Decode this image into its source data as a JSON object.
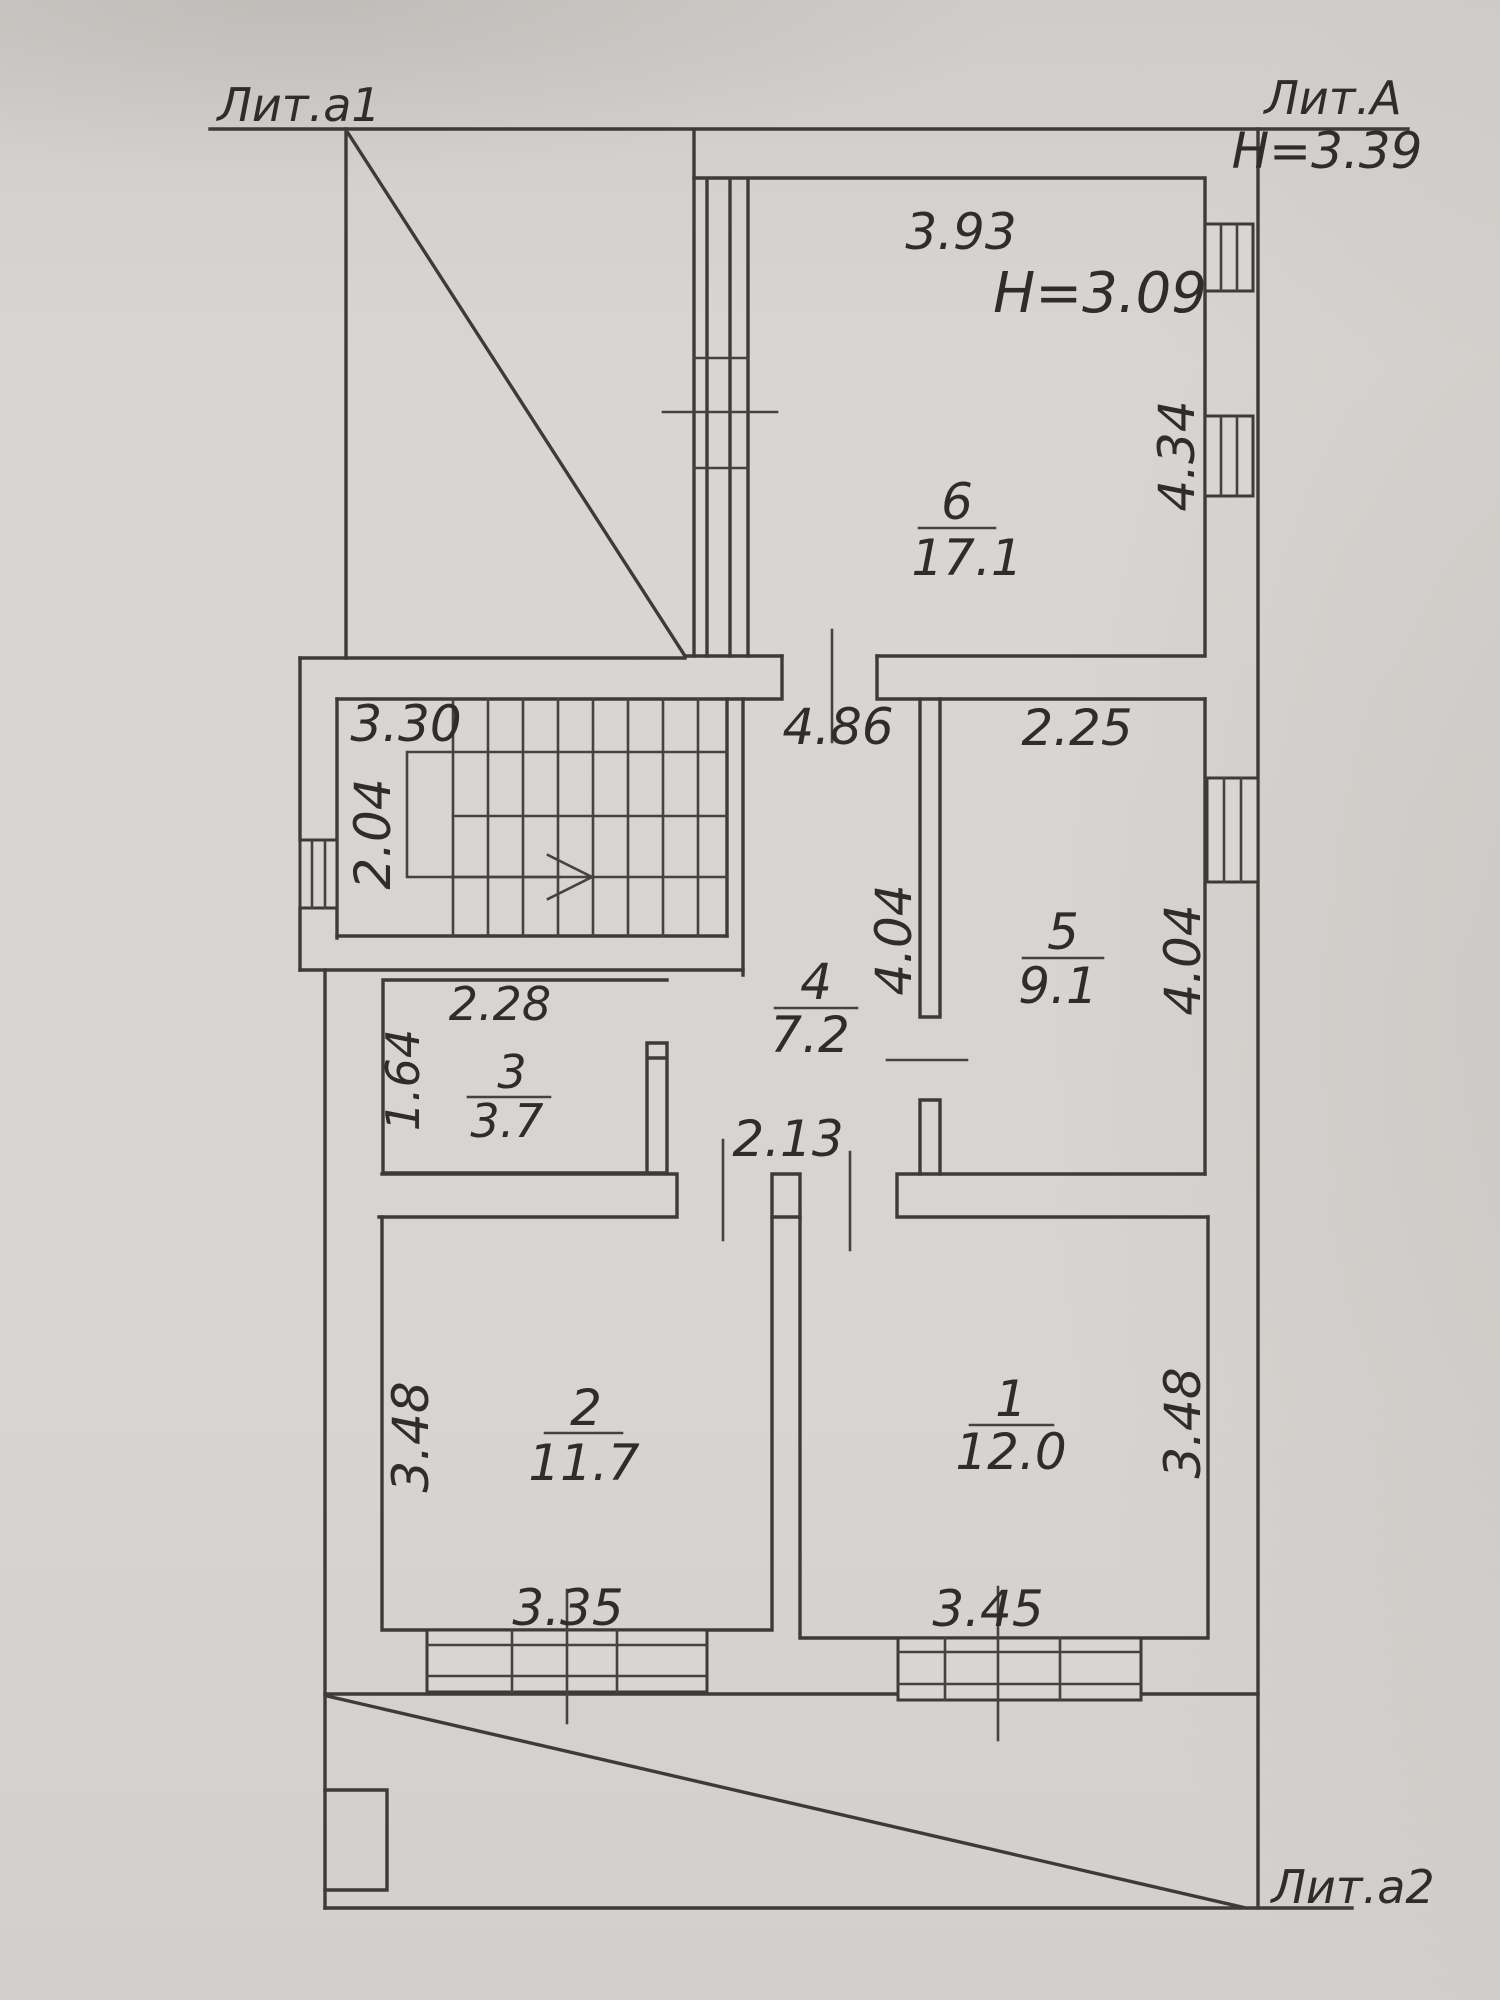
{
  "annotations": {
    "lit_a1": "Лит.а1",
    "lit_a": "Лит.А",
    "lit_a2": "Лит.а2",
    "height_building": "Н=3.39",
    "height_room6": "Н=3.09"
  },
  "rooms": [
    {
      "id": "6",
      "number": "6",
      "area": "17.1",
      "dims": {
        "top": "3.93",
        "right": "4.34"
      }
    },
    {
      "id": "5",
      "number": "5",
      "area": "9.1",
      "dims": {
        "top": "2.25",
        "right": "4.04"
      }
    },
    {
      "id": "4",
      "number": "4",
      "area": "7.2",
      "dims": {
        "top": "4.86",
        "left": "4.04",
        "bottom": "2.13"
      }
    },
    {
      "id": "3",
      "number": "3",
      "area": "3.7",
      "dims": {
        "top": "2.28",
        "left": "1.64"
      }
    },
    {
      "id": "2",
      "number": "2",
      "area": "11.7",
      "dims": {
        "left": "3.48",
        "bottom": "3.35"
      }
    },
    {
      "id": "1",
      "number": "1",
      "area": "12.0",
      "dims": {
        "right": "3.48",
        "bottom": "3.45"
      }
    },
    {
      "id": "stairs",
      "number": "",
      "area": "",
      "dims": {
        "top": "3.30",
        "left": "2.04"
      }
    }
  ]
}
